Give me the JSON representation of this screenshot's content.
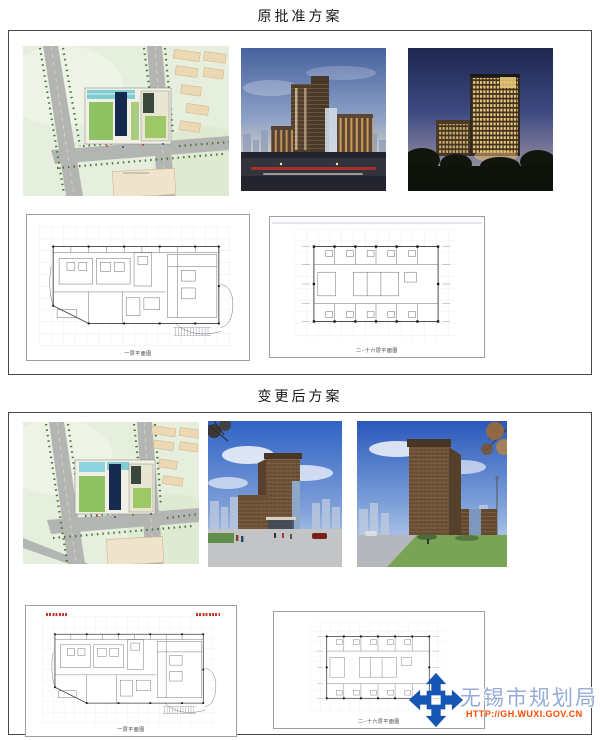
{
  "sections": [
    {
      "title": "原批准方案",
      "floor_plans": [
        {
          "caption": "一层平面图"
        },
        {
          "caption": "二~十六层平面图"
        }
      ]
    },
    {
      "title": "变更后方案",
      "floor_plans": [
        {
          "caption": "一层平面图"
        },
        {
          "caption": "二~十六层平面图"
        }
      ]
    }
  ],
  "watermark": {
    "name": "无锡市规划局",
    "url": "HTTP://GH.WUXI.GOV.CN",
    "colors": {
      "logo_blue": "#1556b4",
      "name_blue": "#96abd8",
      "url_orange": "#ff4a00"
    }
  }
}
